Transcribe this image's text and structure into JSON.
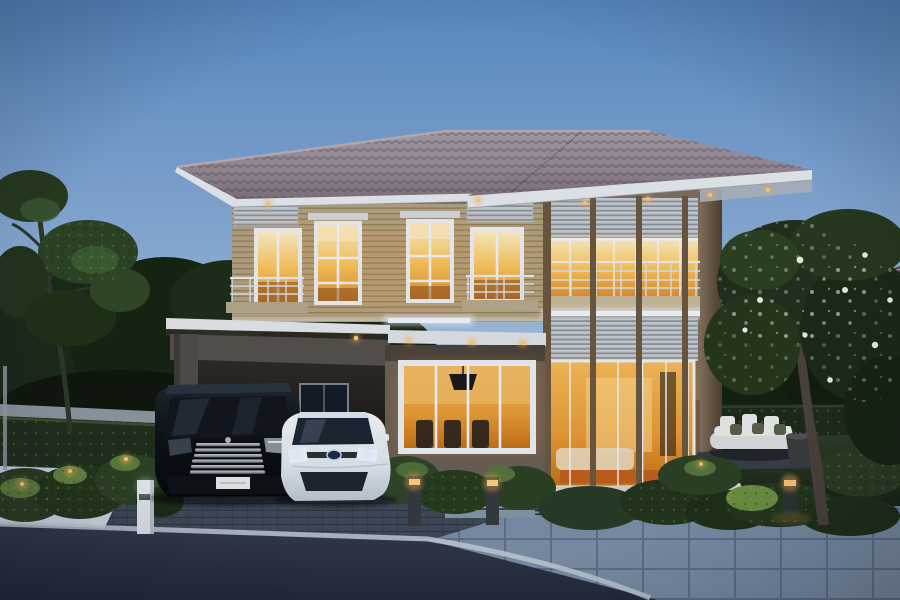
{
  "image": {
    "kind": "photograph",
    "description": "Exterior render of a modern two-storey suburban house at dusk with warm lit windows, a carport sheltering two cars, landscaped hedges, garden lights, a flowering tree and a paver driveway",
    "time_of_day": "dusk"
  },
  "scene": {
    "sky": "clear dusk gradient, deep blue fading to pale horizon",
    "house": {
      "storeys": 2,
      "roof": "hipped roof, mauve-grey tiles, white fascia and gutter",
      "upper_floor": "tan horizontal siding, lit bedroom windows with white frames and shade hoods, two balconies with white railings, louvre vents",
      "right_wing": "double-height section with timber posts, louvre transoms, glazed balcony doors, cream spandrel with white strip light",
      "ground_floor": "carport at left, lit dining-room window at centre, full-height living-room glazing at right, raised terrace with steps",
      "lighting": [
        "warm recessed eave downlights",
        "white LED strip under balcony slab",
        "warm lit interiors"
      ]
    },
    "vehicles": [
      {
        "type": "black luxury MPV van",
        "features": [
          "chrome multi-bar grille",
          "white licence plate"
        ],
        "position": "carport, left bay"
      },
      {
        "type": "white sedan",
        "features": [
          "blue oval maker badge",
          "lit headlights"
        ],
        "position": "carport, right bay"
      }
    ],
    "garden": {
      "left": "tall clipped hedge wall, low shrubs with amber garden lights, white post light, slender trees",
      "front": "shrub beds flanking entry steps with two lit bollard lights",
      "right": "lawn, clipped hedge wall, outdoor daybed with white and olive cushions, dark planter pot, flowering frangipani tree, lit bollard"
    },
    "hardscape": {
      "driveway": "dark brick pavers",
      "walkway": "large blue-grey square pavers",
      "road": "dark asphalt with pale concrete curb"
    },
    "background": [
      "dense tree line at left",
      "neighbouring roof behind tree at right"
    ]
  },
  "palette": {
    "sky_top": "#5a8cc4",
    "sky_horizon": "#dfe6ee",
    "roof_tile": "#948690",
    "fascia_white": "#e6eaed",
    "siding_tan": "#b2a280",
    "wall_brown": "#7f6e5c",
    "wood_post": "#6b573f",
    "carport_grey": "#57504a",
    "window_frame": "#edf0f2",
    "window_glow": "#f0a83c",
    "window_glow_bright": "#ffe9b8",
    "strip_light_white": "#f6fafd",
    "garden_light_amber": "#ffd27a",
    "hedge_green": "#27391f",
    "lawn_green": "#2b3823",
    "driveway_brick": "#3f4856",
    "walkway_paver": "#7c8ea5",
    "asphalt": "#2a3140",
    "curb_white": "#c3ccd6",
    "van_black": "#0b0e12",
    "sedan_white": "#eef2f5",
    "sedan_badge_blue": "#1a2a4a",
    "flower_white": "#f2f4ee",
    "trunk_brown": "#4a423a"
  }
}
